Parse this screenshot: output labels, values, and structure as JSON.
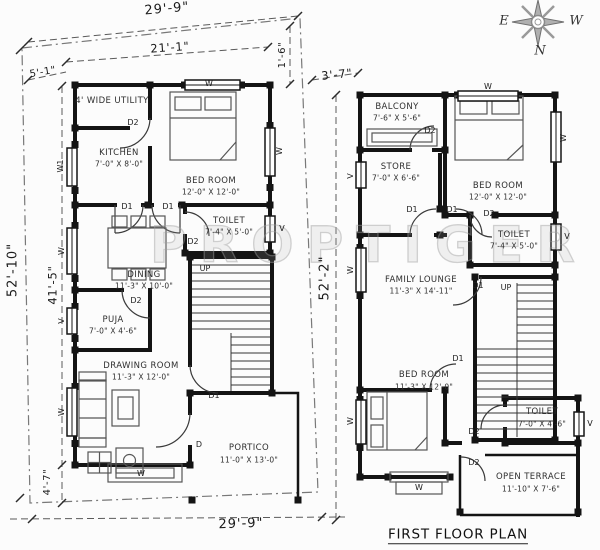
{
  "watermark": "PROPTIGER",
  "compass": {
    "e": "E",
    "w": "W",
    "n": "N"
  },
  "openings": {
    "d1": "D1",
    "d2": "D2",
    "d": "D",
    "w": "W",
    "w1": "W1",
    "v": "V",
    "up": "UP"
  },
  "ground_floor": {
    "dims": {
      "plot_width_top": "29'-9\"",
      "house_width": "21'-1\"",
      "offset_top_left": "5'-1\"",
      "offset_right": "1'-6\"",
      "plot_depth": "52'-10\"",
      "house_depth": "41'-5\"",
      "offset_bottom": "4'-7\"",
      "plot_width_bottom": "29'-9\""
    },
    "rooms": {
      "utility": {
        "name": "4' WIDE UTILITY",
        "size": ""
      },
      "kitchen": {
        "name": "KITCHEN",
        "size": "7'-0\" X 8'-0\""
      },
      "bedroom": {
        "name": "BED ROOM",
        "size": "12'-0\" X 12'-0\""
      },
      "toilet": {
        "name": "TOILET",
        "size": "7'-4\" X 5'-0\""
      },
      "dining": {
        "name": "DINING",
        "size": "11'-3\" X 10'-0\""
      },
      "puja": {
        "name": "PUJA",
        "size": "7'-0\" X 4'-6\""
      },
      "drawing": {
        "name": "DRAWING ROOM",
        "size": "11'-3\" X 12'-0\""
      },
      "portico": {
        "name": "PORTICO",
        "size": "11'-0\" X 13'-0\""
      }
    }
  },
  "first_floor": {
    "title": "FIRST FLOOR PLAN",
    "dims": {
      "offset_front": "3'-7\"",
      "plot_depth": "52'-2\""
    },
    "rooms": {
      "balcony": {
        "name": "BALCONY",
        "size": "7'-6\" X 5'-6\""
      },
      "store": {
        "name": "STORE",
        "size": "7'-0\" X 6'-6\""
      },
      "bedroom_top": {
        "name": "BED ROOM",
        "size": "12'-0\" X 12'-0\""
      },
      "toilet_top": {
        "name": "TOILET",
        "size": "7'-4\" X 5'-0\""
      },
      "lounge": {
        "name": "FAMILY LOUNGE",
        "size": "11'-3\" X 14'-11\""
      },
      "bedroom_bottom": {
        "name": "BED ROOM",
        "size": "11'-3\" X 12'-0\""
      },
      "toilet_bottom": {
        "name": "TOILET",
        "size": "7'-0\" X 4'-6\""
      },
      "terrace": {
        "name": "OPEN TERRACE",
        "size": "11'-10\" X 7'-6\""
      }
    }
  }
}
